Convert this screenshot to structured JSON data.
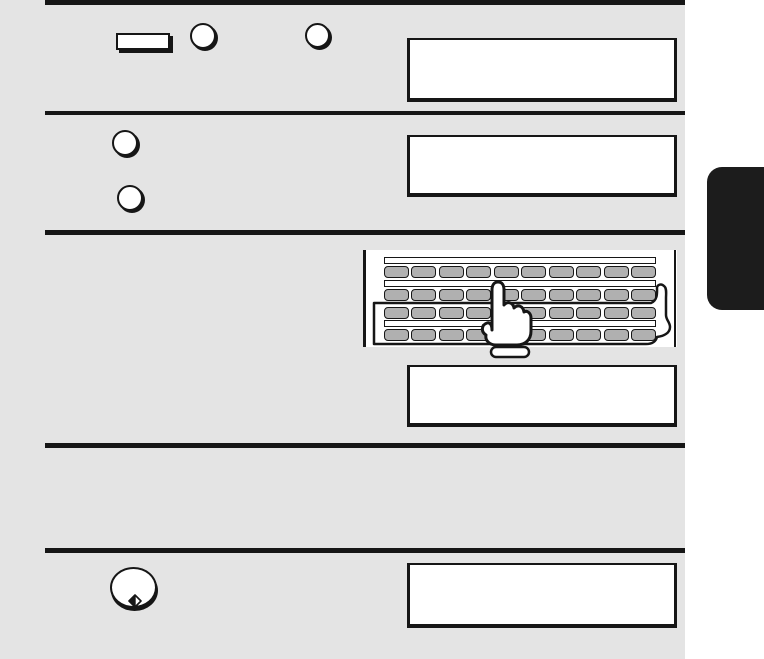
{
  "document": {
    "type": "fax-machine-manual-instruction-page",
    "visible_text": [],
    "note": "Scanned manual page: five instruction rows separated by black rules; all display boxes are blank"
  },
  "colors": {
    "content-bg": "#e4e4e4",
    "ink": "#161616",
    "panel-bg": "#ffffff",
    "key-fill": "#b0b0b0",
    "tab-bg": "#1c1c1c"
  },
  "steps": [
    {
      "index": 1,
      "controls": [
        {
          "icon": "rectangular-key-icon"
        },
        {
          "icon": "round-key-icon"
        },
        {
          "icon": "round-key-icon"
        }
      ],
      "display_text": ""
    },
    {
      "index": 2,
      "controls": [
        {
          "icon": "round-key-icon"
        },
        {
          "icon": "round-key-icon"
        }
      ],
      "display_text": ""
    },
    {
      "index": 3,
      "illustration": {
        "name": "letter-keyboard-with-pointing-hand",
        "key_rows": 4,
        "keys_per_row": 10
      },
      "display_text": ""
    },
    {
      "index": 4,
      "display_text": ""
    },
    {
      "index": 5,
      "controls": [
        {
          "icon": "start-key-icon",
          "glyph": "diamond-with-bar"
        }
      ],
      "display_text": ""
    }
  ],
  "side_tab": {
    "label": ""
  }
}
